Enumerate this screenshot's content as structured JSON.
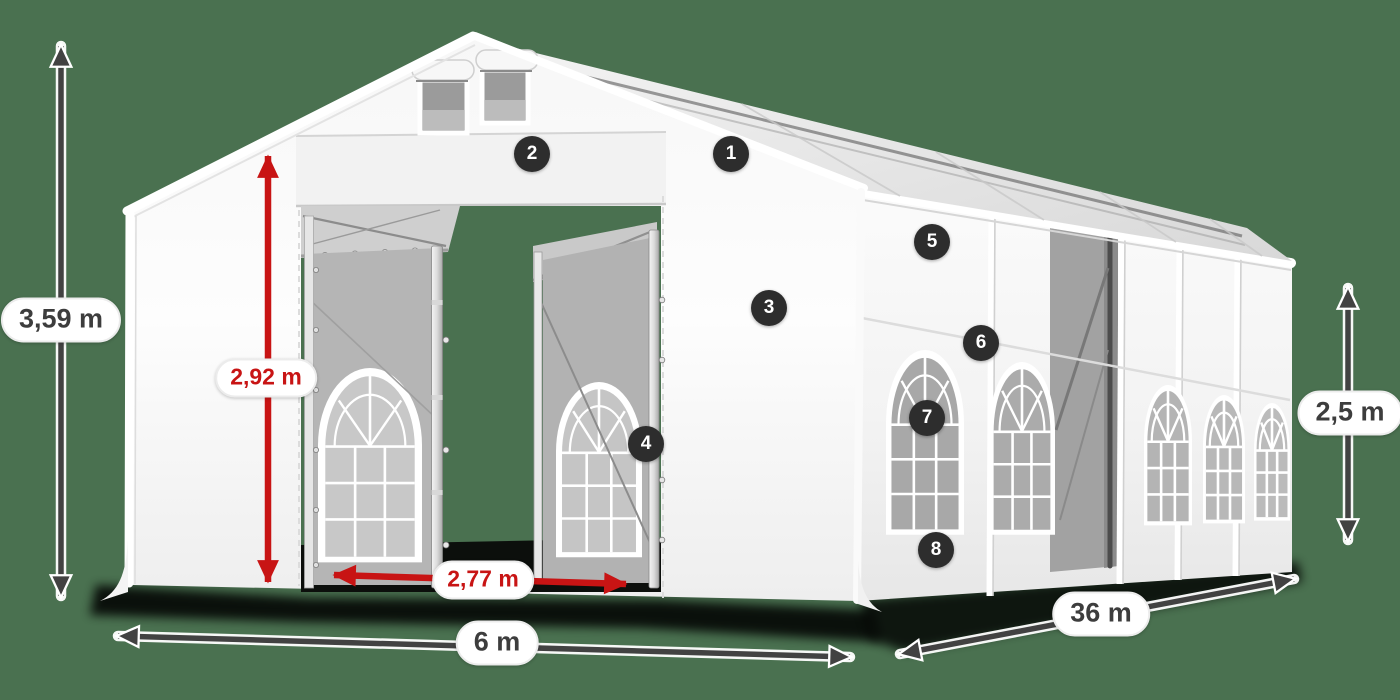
{
  "scene": {
    "background_color": "#4a7150"
  },
  "dimension_labels": {
    "total_height": {
      "text": "3,59 m",
      "style": "dark"
    },
    "entrance_height": {
      "text": "2,92 m",
      "style": "red"
    },
    "entrance_width": {
      "text": "2,77 m",
      "style": "red"
    },
    "front_width": {
      "text": "6 m",
      "style": "dark"
    },
    "length": {
      "text": "36 m",
      "style": "dark"
    },
    "side_height": {
      "text": "2,5 m",
      "style": "dark"
    }
  },
  "feature_badges": [
    {
      "number": "1"
    },
    {
      "number": "2"
    },
    {
      "number": "3"
    },
    {
      "number": "4"
    },
    {
      "number": "5"
    },
    {
      "number": "6"
    },
    {
      "number": "7"
    },
    {
      "number": "8"
    }
  ],
  "colors": {
    "dimension_red": "#c81414",
    "dimension_gray": "#424242",
    "badge_background": "#2d2d2d",
    "background_green": "#4a7150",
    "tent_white": "#f7f7f7"
  }
}
